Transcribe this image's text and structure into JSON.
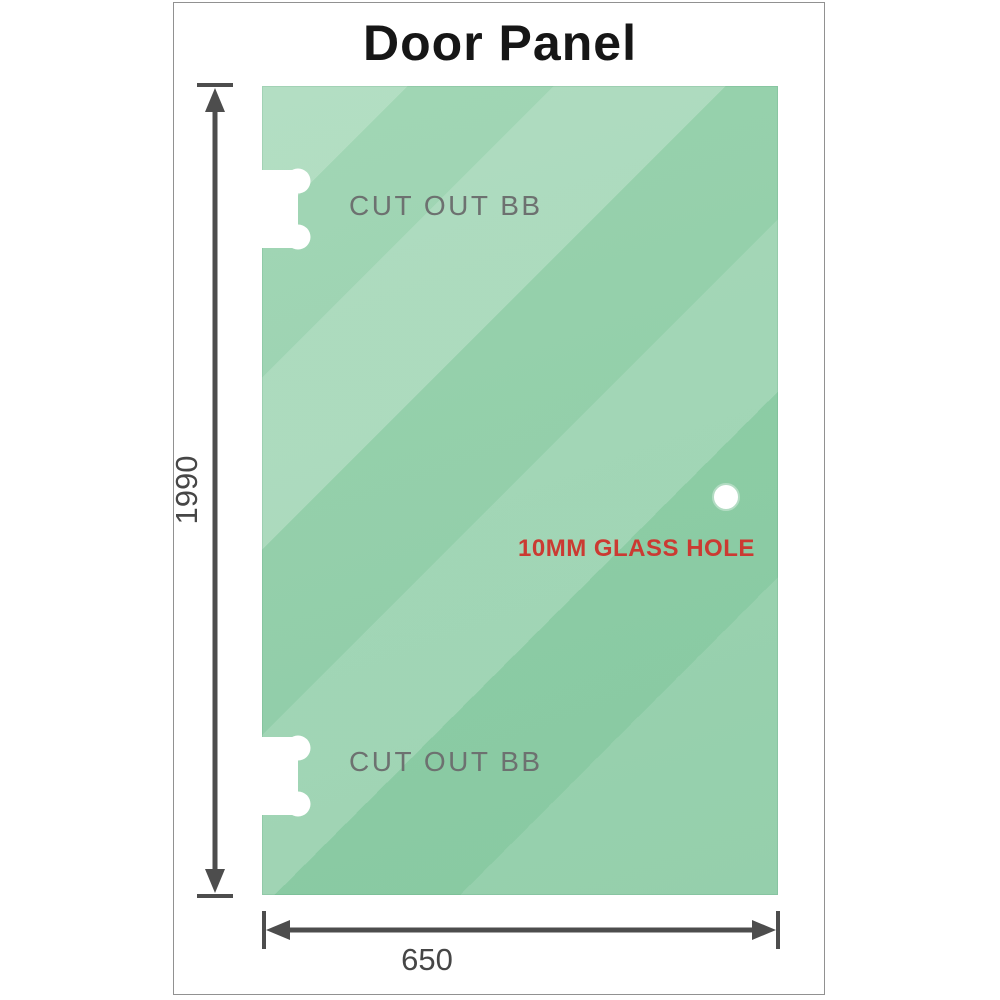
{
  "title": "Door Panel",
  "glass_panel": {
    "cutout_top_label": "CUT OUT BB",
    "cutout_bottom_label": "CUT OUT BB",
    "glass_hole_label": "10MM GLASS HOLE"
  },
  "dimensions": {
    "height_label": "1990",
    "width_label": "650"
  },
  "colors": {
    "glass_base": "#8ccda4",
    "glass_highlight": "#b7e2c6",
    "dimension_line": "#4d4d4d",
    "cutout_text": "#6d7170",
    "hole_text": "#cb3a32",
    "title_text": "#161616",
    "sheet_border": "#919191"
  }
}
